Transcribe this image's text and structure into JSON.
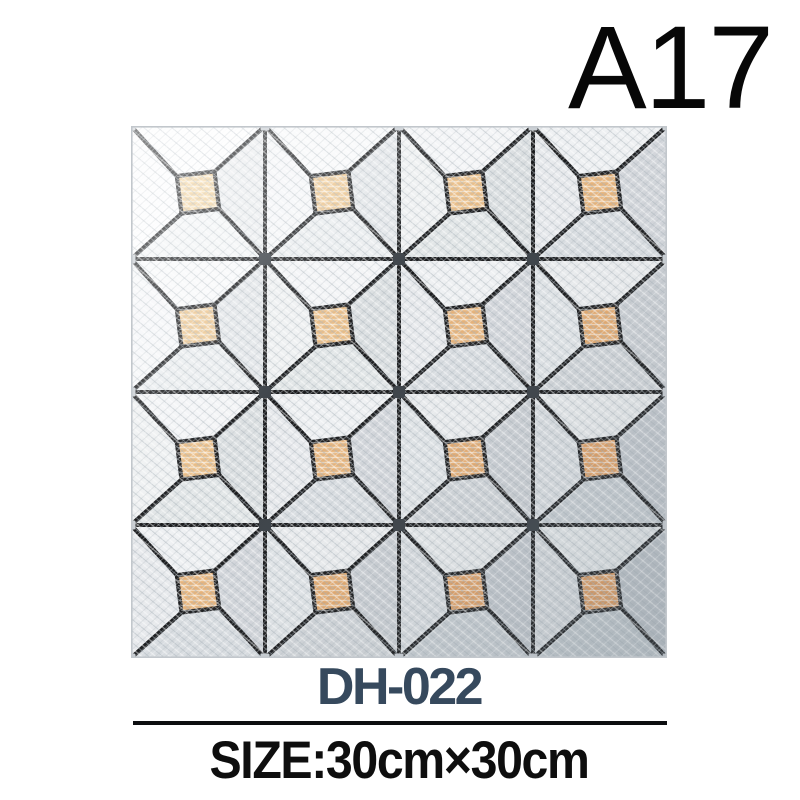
{
  "page": {
    "background": "#ffffff"
  },
  "header": {
    "code": "A17",
    "code_color": "#070707"
  },
  "product": {
    "model": "DH-022",
    "model_color": "#36495d",
    "divider_color": "#0d0e10",
    "size_label": "SIZE:30cm×30cm",
    "size_color": "#0e0e0e"
  },
  "tile": {
    "rows": 4,
    "cols": 4,
    "cell_size": 134,
    "grout_color": "#1a1b1d",
    "grout_width": 4.2,
    "grid_line_width": 4,
    "joint_dot_color": "#3c4248",
    "edge_joint_color": "#c9ced3",
    "metal_light": "#fbfcfd",
    "metal_dark": "#c9cfd4",
    "copper_light": "#f6d9a6",
    "copper_dark": "#e29f63",
    "edge_color": "#c2c7cc",
    "square": {
      "center": 67,
      "half": 19,
      "rotation_deg": -7
    }
  }
}
